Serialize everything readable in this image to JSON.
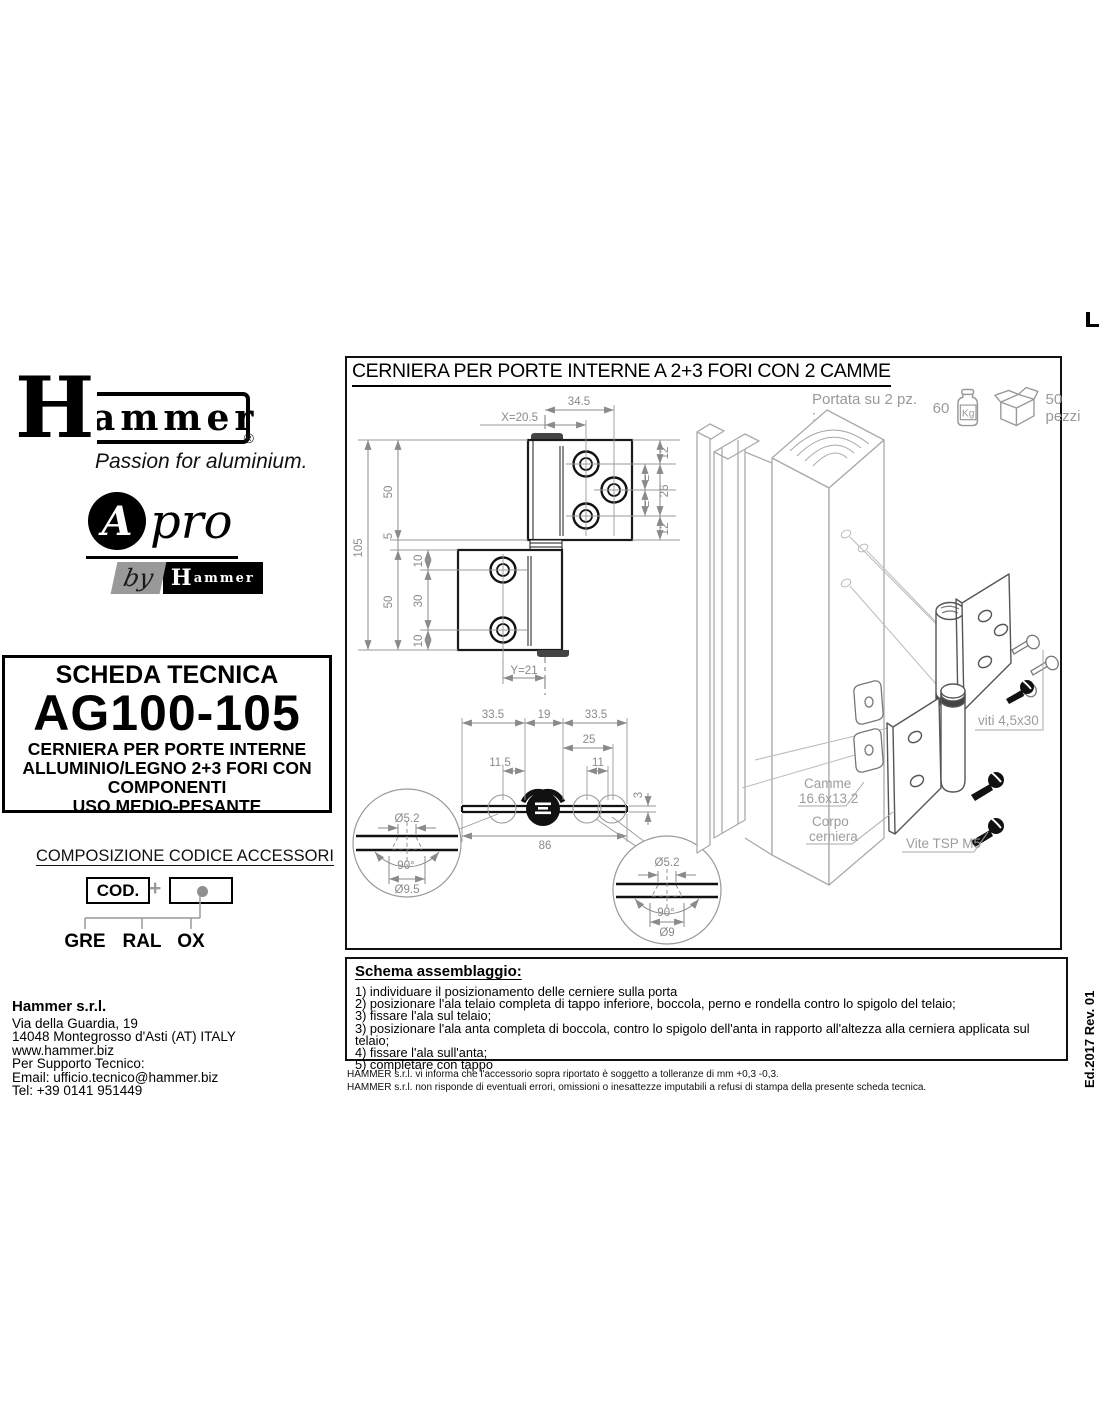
{
  "branding": {
    "logo_h": "H",
    "logo_rest": "ammer",
    "registered": "®",
    "tagline": "Passion for aluminium.",
    "apro": {
      "a": "A",
      "pro": "pro",
      "by": "by",
      "mini_h": "H",
      "mini_rest": "ammer"
    }
  },
  "tech_sheet": {
    "header": "SCHEDA TECNICA",
    "code": "AG100-105",
    "desc_lines": [
      "CERNIERA PER PORTE INTERNE",
      "ALLUMINIO/LEGNO 2+3 FORI CON",
      "COMPONENTI",
      "USO MEDIO-PESANTE"
    ]
  },
  "code_composition": {
    "title": "COMPOSIZIONE CODICE ACCESSORI",
    "cod_label": "COD.",
    "plus": "+",
    "options": [
      "GRE",
      "RAL",
      "OX"
    ]
  },
  "contact": {
    "company": "Hammer s.r.l.",
    "lines": [
      "Via della Guardia, 19",
      "14048 Montegrosso d'Asti (AT) ITALY",
      "www.hammer.biz",
      "Per Supporto Tecnico:",
      "Email: ufficio.tecnico@hammer.biz",
      "Tel: +39 0141 951449"
    ]
  },
  "drawing": {
    "title": "CERNIERA PER PORTE INTERNE A 2+3 FORI CON 2 CAMME",
    "capacity_prefix": "Portata su 2 pz. :",
    "capacity_value": "60",
    "capacity_unit": "Kg",
    "pack_qty": "50 pezzi",
    "front": {
      "dims": {
        "xoff": "X=20.5",
        "topw": "34.5",
        "overall": "105",
        "upper": "50",
        "gap": "5",
        "lower": "50",
        "htop": "10",
        "hspan": "30",
        "hbot": "10",
        "rtop": "12",
        "rmid": "26",
        "rbot": "12",
        "eq1": "=",
        "eq2": "=",
        "yoff": "Y=21"
      }
    },
    "section": {
      "dims": {
        "w1": "33.5",
        "w2": "19",
        "w3": "33.5",
        "d25": "25",
        "d115": "11.5",
        "d11": "11",
        "d3": "3",
        "d86": "86"
      }
    },
    "detail_left": {
      "dia": "Ø5.2",
      "angle": "90°",
      "head": "Ø9.5"
    },
    "detail_right": {
      "dia": "Ø5.2",
      "angle": "90°",
      "head": "Ø9"
    },
    "exploded": {
      "viti": "viti 4,5x30",
      "camme1": "Camme",
      "camme2": "16.6x13.2",
      "corpo1": "Corpo",
      "corpo2": "cerniera",
      "vite": "Vite TSP M5"
    }
  },
  "assembly": {
    "title": "Schema assemblaggio:",
    "steps": [
      "1) individuare il posizionamento delle cerniere sulla porta",
      "2) posizionare l'ala telaio completa di tappo inferiore, boccola, perno e rondella contro lo spigolo del telaio;",
      "3) fissare l'ala sul telaio;",
      "3) posizionare l'ala anta completa di boccola, contro lo spigolo dell'anta in rapporto all'altezza alla cerniera applicata sul telaio;",
      "4) fissare l'ala sull'anta;",
      "5) completare con tappo"
    ],
    "disclaimers": [
      "HAMMER s.r.l. vi informa che l'accessorio sopra riportato è soggetto a tolleranze di mm +0,3 -0,3.",
      "HAMMER s.r.l. non risponde di eventuali errori, omissioni o inesattezze imputabili a refusi di stampa della presente scheda tecnica."
    ]
  },
  "edition": "Ed.2017 Rev. 01"
}
